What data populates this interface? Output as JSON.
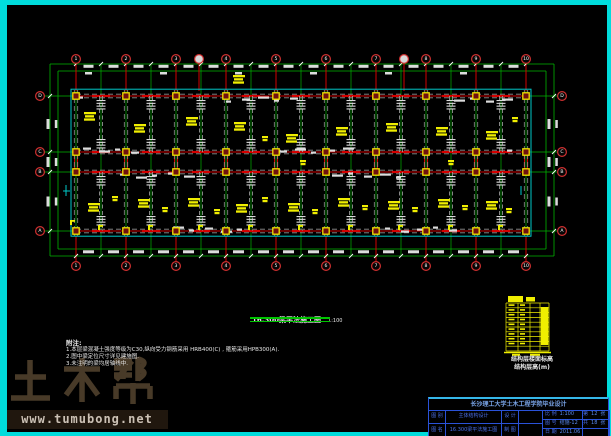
{
  "frame": {
    "border_color": "#00dcdc",
    "background": "#000000"
  },
  "watermark": {
    "brand": "土木帮",
    "url": "www.tumubong.net"
  },
  "caption": {
    "title": "16.300梁平法施工图",
    "scale": "1:100"
  },
  "notes": {
    "title": "附注:",
    "lines": [
      "1.本层梁混凝土强度等级为C30,纵向受力钢筋采用 HRB400(C) , 箍筋采用HPB300(A).",
      "2.图中梁定位尺寸详见建施图.",
      "3.未注明的梁均居轴线中."
    ]
  },
  "elev_table": {
    "caption_line1": "结构层楼面标高",
    "caption_line2": "结构层高(m)"
  },
  "title_block": {
    "title": "长沙理工大学土木工程学院毕业设计",
    "c_tubie_label": "图 别",
    "c_tuming_label": "图 名",
    "project_line1": "主体结构设计",
    "project_line2": "16.300梁平法施工图",
    "c_sheji": "设 计",
    "c_zhitu": "制 图",
    "c_bili_label": "比 例",
    "c_bili_value": "1:100",
    "c_tuhao_label": "图 号",
    "c_tuhao_value": "结施-12",
    "c_riqi_label": "日 期",
    "c_riqi_value": "2011.06",
    "c_di": "第",
    "c_di_value": "12",
    "c_zhang": "张",
    "c_gong": "共",
    "c_gong_value": "18",
    "c_zhang2": "张"
  },
  "plan": {
    "axes_x": [
      76,
      126,
      176,
      226,
      276,
      326,
      376,
      426,
      476,
      526
    ],
    "axis_labels": [
      "1",
      "2",
      "3",
      "4",
      "5",
      "6",
      "7",
      "8",
      "9",
      "10"
    ],
    "sub_axes_x": [
      199,
      404
    ],
    "rows_y": [
      96,
      152,
      172,
      231
    ],
    "row_labels": [
      "D",
      "C",
      "B",
      "A"
    ],
    "plan_left": 72,
    "plan_right": 530,
    "plan_top": 90,
    "plan_bottom": 236,
    "colors": {
      "grid": "#00b400",
      "axis": "#d40000",
      "beam": "#909090",
      "beam2": "#a8a8a8",
      "slab": "#00c8c8",
      "column_fill": "#701010",
      "column_stroke": "#f2e400",
      "label": "#f0ee00",
      "dim_text": "#dcdcdc",
      "bubble_ring": "#d03030",
      "bubble_text": "#ffffff"
    },
    "beam_labels": [
      [
        84,
        112,
        0
      ],
      [
        134,
        124,
        0
      ],
      [
        186,
        117,
        0
      ],
      [
        233,
        75,
        0
      ],
      [
        234,
        122,
        0
      ],
      [
        262,
        136,
        1
      ],
      [
        286,
        134,
        0
      ],
      [
        336,
        127,
        0
      ],
      [
        386,
        123,
        0
      ],
      [
        436,
        127,
        0
      ],
      [
        486,
        131,
        0
      ],
      [
        512,
        117,
        1
      ],
      [
        300,
        160,
        1
      ],
      [
        448,
        160,
        1
      ],
      [
        88,
        203,
        0
      ],
      [
        112,
        196,
        1
      ],
      [
        138,
        199,
        0
      ],
      [
        162,
        207,
        1
      ],
      [
        188,
        198,
        0
      ],
      [
        214,
        209,
        1
      ],
      [
        236,
        204,
        0
      ],
      [
        262,
        197,
        1
      ],
      [
        288,
        203,
        0
      ],
      [
        312,
        209,
        1
      ],
      [
        338,
        198,
        0
      ],
      [
        362,
        205,
        1
      ],
      [
        388,
        201,
        0
      ],
      [
        412,
        207,
        1
      ],
      [
        438,
        199,
        0
      ],
      [
        462,
        205,
        1
      ],
      [
        486,
        201,
        0
      ],
      [
        506,
        208,
        1
      ],
      [
        98,
        225,
        2
      ],
      [
        148,
        225,
        2
      ],
      [
        198,
        225,
        2
      ],
      [
        248,
        225,
        2
      ],
      [
        298,
        225,
        2
      ],
      [
        348,
        225,
        2
      ],
      [
        398,
        225,
        2
      ],
      [
        448,
        225,
        2
      ],
      [
        498,
        225,
        2
      ],
      [
        70,
        220,
        2
      ]
    ]
  }
}
